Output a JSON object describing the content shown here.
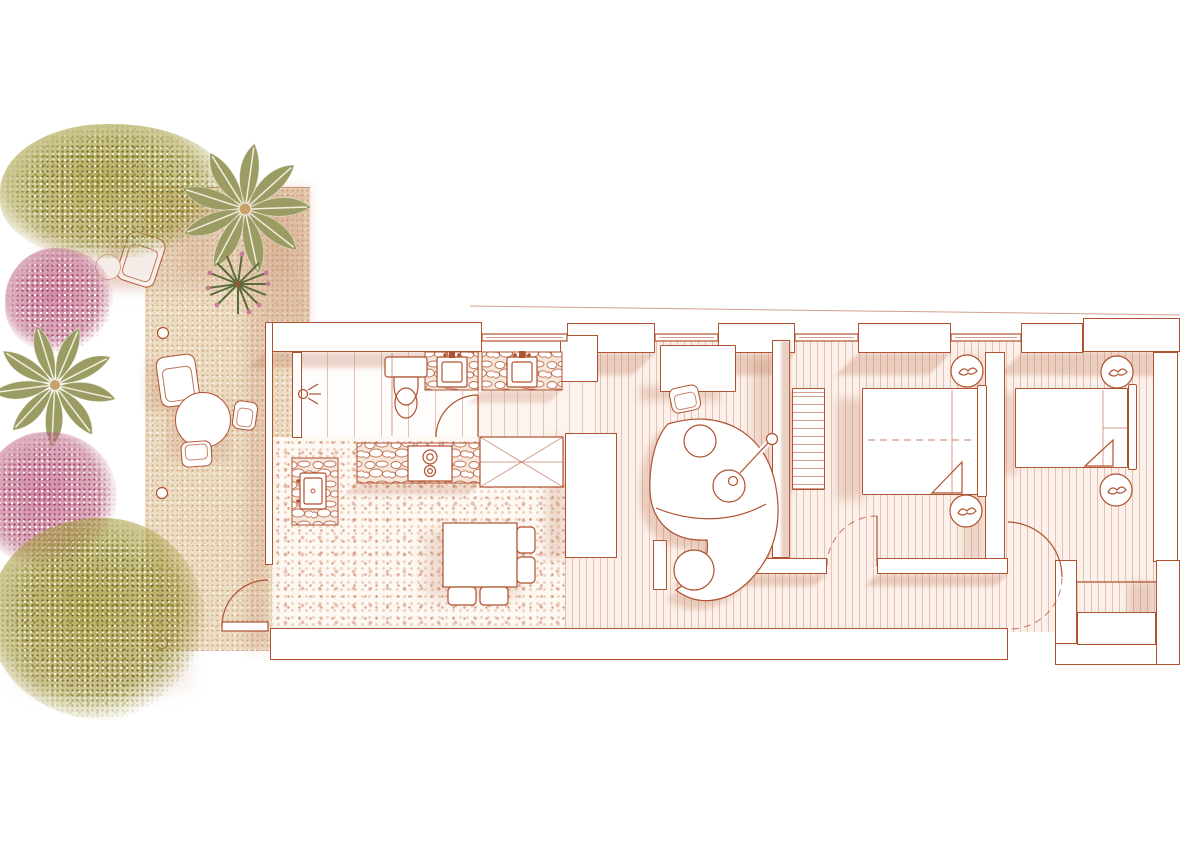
{
  "title": "apartment-floor-plan-with-terrace",
  "palette": {
    "line": "#b0512f",
    "lineSoft": "#cf8a68",
    "wallFill": "#ffffff",
    "shadow": "#c07c5c",
    "sand": "#ecdcc2",
    "sandShadow": "#c8a07a",
    "plankLine": "#c98d72",
    "terrazzoDot": "#bb5a36",
    "oliveGreen": "#a79e3e",
    "oliveDark": "#6d6626",
    "palmGreen": "#9b9c63",
    "palmLight": "#c2c29a",
    "pinkFlower": "#c97b97",
    "pinkDeep": "#963a60",
    "spikeGreen": "#5c6b3a",
    "potBrown": "#8a5a3a"
  },
  "rooms": [
    {
      "name": "terrace",
      "floor": "sand"
    },
    {
      "name": "bathroom",
      "floor": "tile"
    },
    {
      "name": "hall-washbasin",
      "floor": "wood"
    },
    {
      "name": "kitchen-dining",
      "floor": "terrazzo"
    },
    {
      "name": "living-room",
      "floor": "wood-planks"
    },
    {
      "name": "corridor",
      "floor": "wood-planks"
    },
    {
      "name": "bedroom-1",
      "floor": "wood-planks"
    },
    {
      "name": "bedroom-2",
      "floor": "wood-planks"
    },
    {
      "name": "entry-niche",
      "floor": "wood-planks"
    }
  ],
  "terrace_items": [
    "lounge-chair",
    "lounge-chair",
    "side-table",
    "round-table",
    "chair",
    "chair",
    "ground-light",
    "ground-light",
    "ground-light"
  ],
  "plants": [
    "olive-tree",
    "palm-tree",
    "spiky-plant",
    "pink-bush",
    "palm-tree",
    "bougainvillea",
    "olive-tree"
  ],
  "fixtures": [
    "shower",
    "toilet",
    "vanity-sink",
    "hall-sink",
    "kitchen-sink",
    "cooktop",
    "kitchen-counter",
    "tall-cabinet"
  ],
  "furniture": [
    "dining-table",
    "dining-chairs",
    "desk",
    "desk-chair",
    "curved-sofa",
    "round-cushions",
    "guitar",
    "wall-shelf-radiator",
    "double-bed",
    "double-bed",
    "bedside-table",
    "bedside-table",
    "bedside-table",
    "bedside-table"
  ],
  "openings": [
    "entry-door",
    "bathroom-door",
    "bedroom-1-door",
    "bedroom-2-door",
    "window",
    "window",
    "window",
    "window"
  ]
}
